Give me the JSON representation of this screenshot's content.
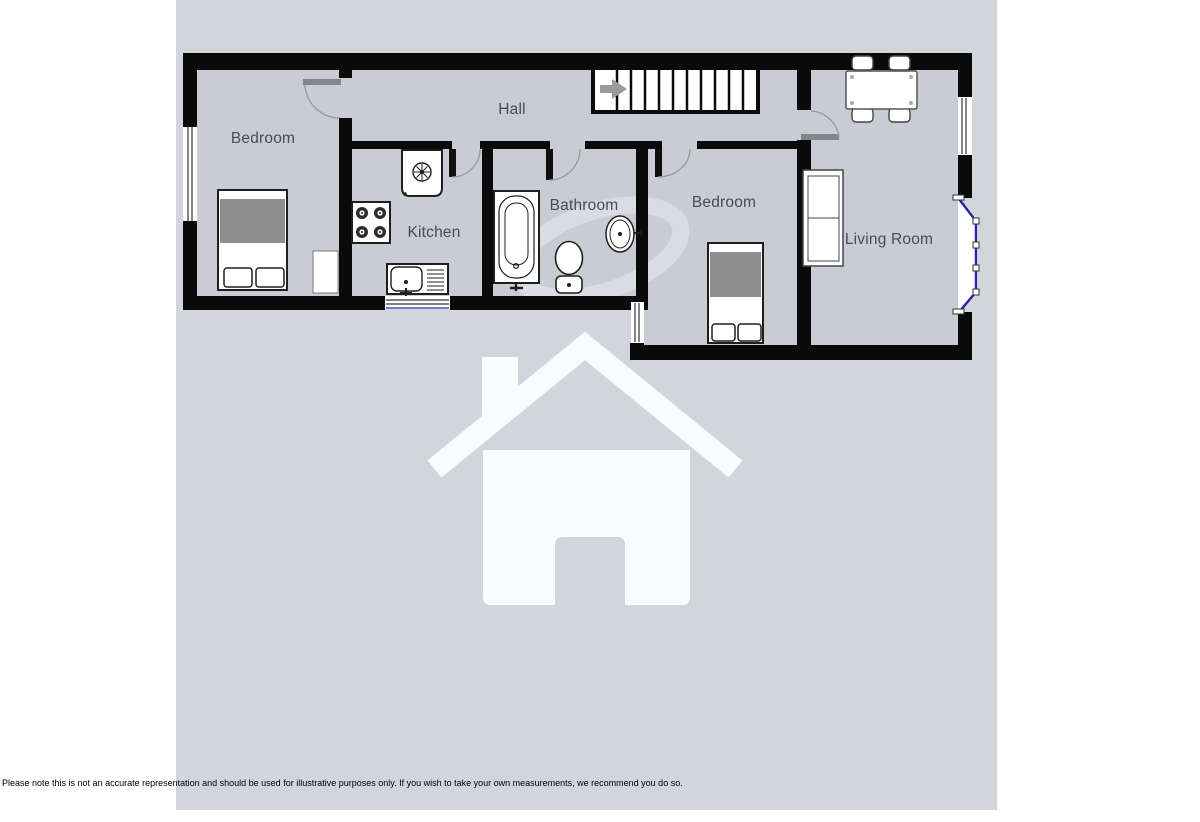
{
  "page": {
    "background_color": "#ffffff",
    "panel_color": "#d3d5dd",
    "floor_color": "#c9ccd4",
    "wall_color": "#0a0a0a",
    "bay_window_color": "#2525ae",
    "label_color": "#474c58",
    "watermark_color": "#fafbfc"
  },
  "floorplan": {
    "rooms": [
      {
        "name": "bedroom-left",
        "label": "Bedroom"
      },
      {
        "name": "hall",
        "label": "Hall"
      },
      {
        "name": "kitchen",
        "label": "Kitchen"
      },
      {
        "name": "bathroom",
        "label": "Bathroom"
      },
      {
        "name": "bedroom-right",
        "label": "Bedroom"
      },
      {
        "name": "living-room",
        "label": "Living Room"
      }
    ],
    "fixtures": [
      "stairs",
      "double-bed",
      "wardrobe",
      "boiler",
      "hob",
      "kitchen-sink",
      "bath",
      "toilet",
      "basin",
      "single-bed",
      "sofa",
      "dining-table",
      "dining-chairs",
      "bay-window",
      "windows",
      "doors"
    ],
    "watermarks": [
      "house-logo",
      "swirl"
    ]
  },
  "disclaimer": "Please note this is not an accurate representation and should be used for illustrative purposes only. If you wish to take your own measurements, we recommend you do so."
}
